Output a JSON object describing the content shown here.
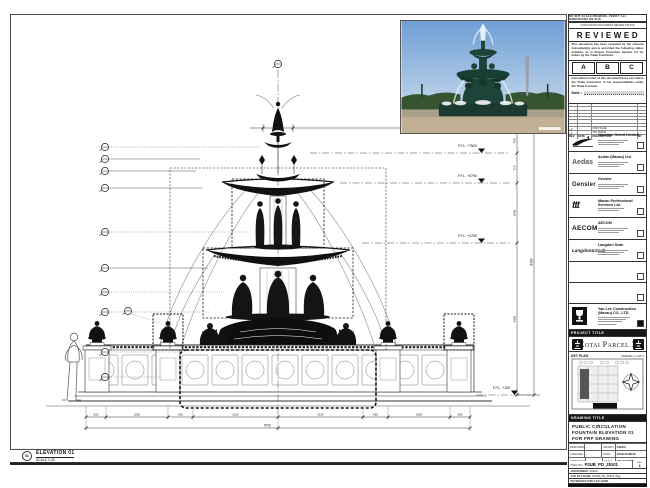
{
  "sheet": {
    "top_note": "DO NOT SCALE DRAWING. VERIFY ALL DIMENSIONS ON SITE"
  },
  "reviewed": {
    "header": "CONSULTANT DOCUMENT REVIEW STATUS",
    "title": "REVIEWED",
    "para1": "This document has been reviewed by the relevant Consultant(s) and is accorded the following status notation, as in Project Procedure Section 5.4 for action by the Trade Contractor.",
    "grades": [
      "A",
      "B",
      "C"
    ],
    "para2": "Consultant review of this document does not relieve the Trade Contractor of his responsibilities under the Trade Contract.",
    "date_label": "Date :"
  },
  "revisions": {
    "columns": [
      "REV",
      "DATE",
      "DESCRIPTION",
      "BY"
    ],
    "rows": [
      {
        "rev": "△2",
        "date": "",
        "desc": "2ND ISSUE",
        "by": ""
      },
      {
        "rev": "△1",
        "date": "",
        "desc": "1ST ISSUE",
        "by": ""
      }
    ]
  },
  "stamps": [
    {
      "logo_text": "",
      "name": "Venetian Orient Limited"
    },
    {
      "logo_text": "Aedas",
      "name": "Aedas (Macau) Ltd."
    },
    {
      "logo_text": "Gensler",
      "name": "Gensler"
    },
    {
      "logo_text": "ttt",
      "name": "Macau Professional Services Ltd."
    },
    {
      "logo_text": "AECOM",
      "name": "AECOM"
    },
    {
      "logo_text": "Langdon&Seah",
      "name": "Langdon Seah"
    },
    {
      "logo_text": "",
      "name": ""
    },
    {
      "logo_text": "",
      "name": ""
    },
    {
      "logo_text": "",
      "name": "Yau Lee Construction (Macau) CO., LTD."
    }
  ],
  "project": {
    "header": "PROJECT TITLE",
    "title": "Cotai Parcel 3"
  },
  "key_plan": {
    "header": "KEY PLAN",
    "parcel_label": "PARCEL 1, LOT 2",
    "tag": "FOUNTAIN 01"
  },
  "title_block": {
    "header": "DRAWING TITLE",
    "line1": "PUBLIC CIRCULATION",
    "line2": "FOUNTAIN ELEVATION 01",
    "line3": "FOR FRP DRAWING",
    "designed_label": "DESIGNED",
    "designed": "-",
    "drawn_label": "DRAWN",
    "drawn": "CHAO",
    "checked_label": "CHECKED",
    "checked": "-",
    "date_label": "DATE",
    "date": "12/AUG/2016",
    "approved_label": "APPROVED",
    "approved": "-",
    "scale_label": "SCALE",
    "scale": "AS SHOWN",
    "dwg_no_label": "DWG NO.",
    "dwg_no": "P3UB_PD_25101",
    "rev_label": "REV",
    "rev": "2",
    "job_label": "JOB NUMBER",
    "job": "31123",
    "cad_label": "CAD FILE NAME",
    "cad": "P3UB_PD_25101.dwg",
    "ref_label": "REFERENCE DWG FILE NAME",
    "ref": "-"
  },
  "elevation_tag": {
    "number": "01",
    "title": "ELEVATION 01",
    "scale": "SCALE 1:25"
  },
  "drawing": {
    "levels": [
      "F.F.L. +7500",
      "F.F.L. +6790",
      "F.F.L. +4750",
      "F.F.L. +150"
    ],
    "dim_top": "600",
    "vdims": [
      "750",
      "710",
      "2040",
      "4600"
    ],
    "vdim_total": "8100",
    "bottom_dims": [
      "500",
      "1550",
      "625",
      "2125",
      "2125",
      "625",
      "1550",
      "500"
    ],
    "bottom_total": "9700"
  }
}
